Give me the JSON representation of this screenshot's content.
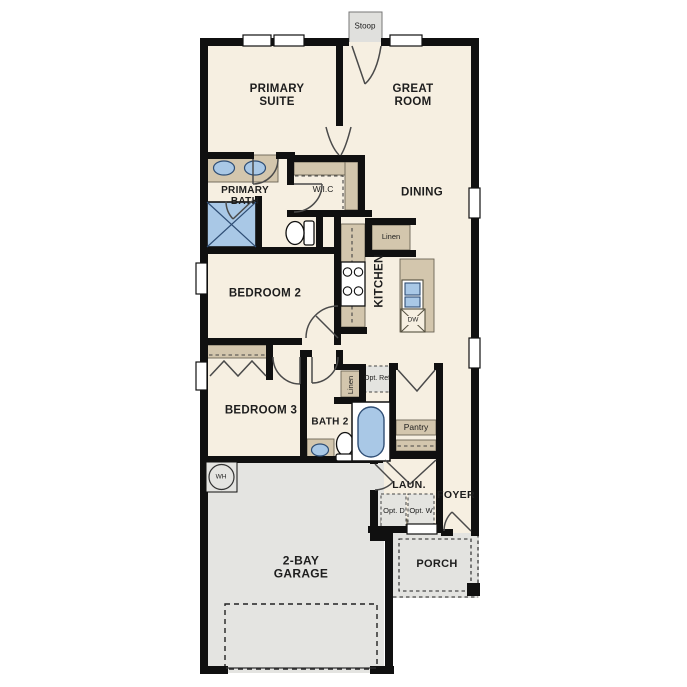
{
  "plan": {
    "labels": {
      "stoop": "Stoop",
      "primary_suite": "PRIMARY SUITE",
      "great_room": "GREAT ROOM",
      "primary_bath": "PRIMARY BATH",
      "wic": "W.I.C",
      "dining": "DINING",
      "linen_upper": "Linen",
      "bedroom2": "BEDROOM 2",
      "kitchen": "KITCHEN",
      "dw": "DW",
      "bedroom3": "BEDROOM 3",
      "bath2": "BATH 2",
      "linen_lower": "Linen",
      "opt_ref": "Opt. Ref.",
      "pantry": "Pantry",
      "laun": "LAUN.",
      "foyer": "FOYER",
      "opt_d": "Opt. D",
      "opt_w": "Opt. W",
      "wh": "WH",
      "garage": "2-BAY GARAGE",
      "porch": "PORCH"
    },
    "palette": {
      "floor": "#f6efe1",
      "garage_floor": "#e4e4e1",
      "porch_floor": "#e3e3e0",
      "wall": "#101010",
      "cabinet_tan": "#d3c6ad",
      "fixture_blue": "#a9c8e6",
      "door_stroke": "#4a4a4a",
      "optional_box": "#e4e4e0"
    }
  }
}
